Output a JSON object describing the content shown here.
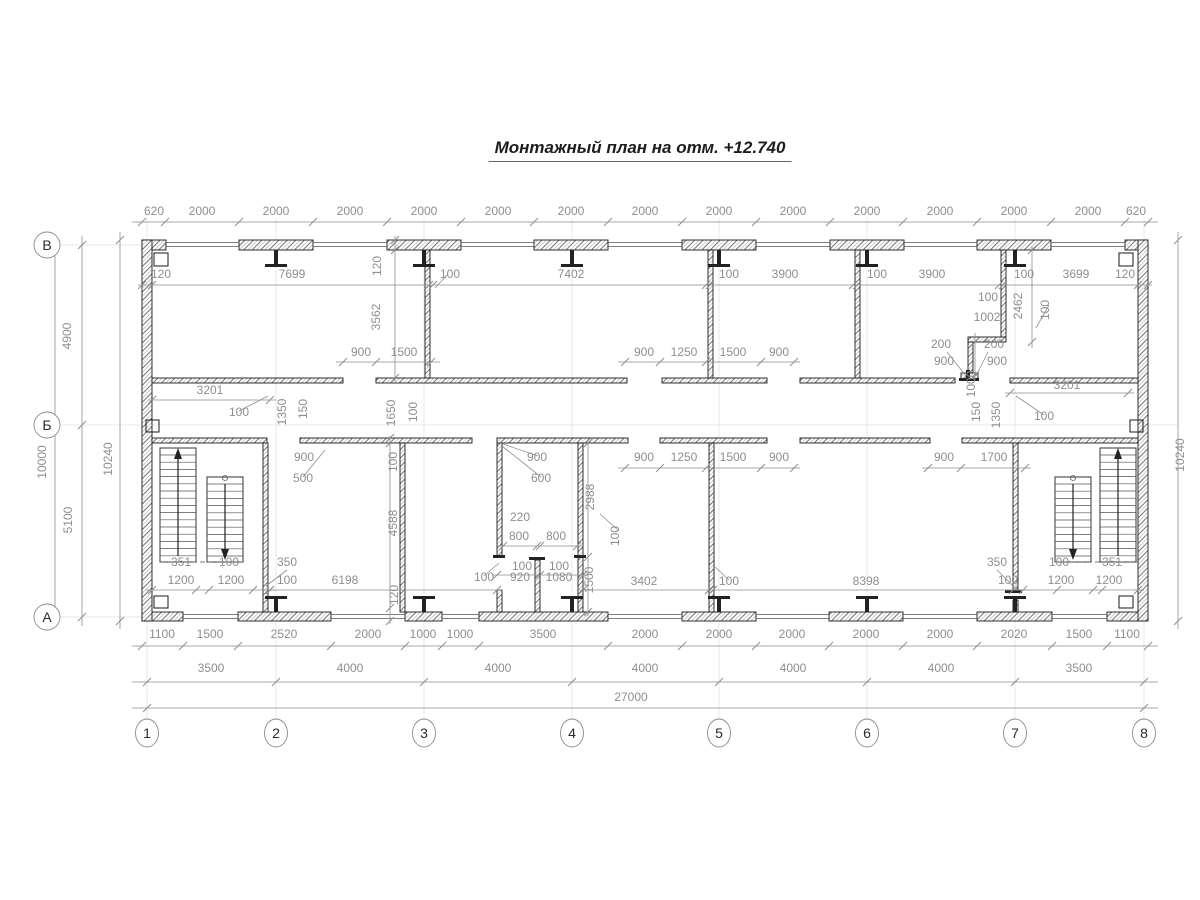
{
  "title": {
    "text": "Монтажный план на отм. +12.740"
  },
  "drawing": {
    "axis_bubbles_left": [
      {
        "label": "В",
        "x": 47,
        "y": 245
      },
      {
        "label": "Б",
        "x": 47,
        "y": 425
      },
      {
        "label": "А",
        "x": 47,
        "y": 617
      }
    ],
    "axis_bubbles_bottom": [
      {
        "label": "1",
        "x": 147,
        "y": 733
      },
      {
        "label": "2",
        "x": 276,
        "y": 733
      },
      {
        "label": "3",
        "x": 424,
        "y": 733
      },
      {
        "label": "4",
        "x": 572,
        "y": 733
      },
      {
        "label": "5",
        "x": 719,
        "y": 733
      },
      {
        "label": "6",
        "x": 867,
        "y": 733
      },
      {
        "label": "7",
        "x": 1015,
        "y": 733
      },
      {
        "label": "8",
        "x": 1144,
        "y": 733
      }
    ],
    "dim_labels": [
      {
        "t": "620",
        "x": 154,
        "y": 215
      },
      {
        "t": "2000",
        "x": 202,
        "y": 215
      },
      {
        "t": "2000",
        "x": 276,
        "y": 215
      },
      {
        "t": "2000",
        "x": 350,
        "y": 215
      },
      {
        "t": "2000",
        "x": 424,
        "y": 215
      },
      {
        "t": "2000",
        "x": 498,
        "y": 215
      },
      {
        "t": "2000",
        "x": 571,
        "y": 215
      },
      {
        "t": "2000",
        "x": 645,
        "y": 215
      },
      {
        "t": "2000",
        "x": 719,
        "y": 215
      },
      {
        "t": "2000",
        "x": 793,
        "y": 215
      },
      {
        "t": "2000",
        "x": 867,
        "y": 215
      },
      {
        "t": "2000",
        "x": 940,
        "y": 215
      },
      {
        "t": "2000",
        "x": 1014,
        "y": 215
      },
      {
        "t": "2000",
        "x": 1088,
        "y": 215
      },
      {
        "t": "620",
        "x": 1136,
        "y": 215
      },
      {
        "t": "120",
        "x": 161,
        "y": 278
      },
      {
        "t": "7699",
        "x": 292,
        "y": 278
      },
      {
        "t": "100",
        "x": 450,
        "y": 278
      },
      {
        "t": "7402",
        "x": 571,
        "y": 278
      },
      {
        "t": "100",
        "x": 729,
        "y": 278
      },
      {
        "t": "3900",
        "x": 785,
        "y": 278
      },
      {
        "t": "100",
        "x": 877,
        "y": 278
      },
      {
        "t": "3900",
        "x": 932,
        "y": 278
      },
      {
        "t": "100",
        "x": 1024,
        "y": 278
      },
      {
        "t": "3699",
        "x": 1076,
        "y": 278
      },
      {
        "t": "120",
        "x": 1125,
        "y": 278
      },
      {
        "t": "4900",
        "x": 71,
        "y": 336,
        "r": -90
      },
      {
        "t": "10000",
        "x": 46,
        "y": 462,
        "r": -90
      },
      {
        "t": "5100",
        "x": 72,
        "y": 520,
        "r": -90
      },
      {
        "t": "10240",
        "x": 112,
        "y": 459,
        "r": -90
      },
      {
        "t": "10240",
        "x": 1184,
        "y": 455,
        "r": -90
      },
      {
        "t": "120",
        "x": 381,
        "y": 266,
        "r": -90
      },
      {
        "t": "3562",
        "x": 380,
        "y": 317,
        "r": -90
      },
      {
        "t": "900",
        "x": 361,
        "y": 356
      },
      {
        "t": "1500",
        "x": 404,
        "y": 356
      },
      {
        "t": "3201",
        "x": 210,
        "y": 394
      },
      {
        "t": "100",
        "x": 239,
        "y": 416
      },
      {
        "t": "1350",
        "x": 286,
        "y": 412,
        "r": -90
      },
      {
        "t": "150",
        "x": 307,
        "y": 409,
        "r": -90
      },
      {
        "t": "1650",
        "x": 395,
        "y": 413,
        "r": -90
      },
      {
        "t": "100",
        "x": 417,
        "y": 412,
        "r": -90
      },
      {
        "t": "900",
        "x": 644,
        "y": 356
      },
      {
        "t": "1250",
        "x": 684,
        "y": 356
      },
      {
        "t": "1500",
        "x": 733,
        "y": 356
      },
      {
        "t": "900",
        "x": 779,
        "y": 356
      },
      {
        "t": "100",
        "x": 988,
        "y": 301
      },
      {
        "t": "1002",
        "x": 987,
        "y": 321
      },
      {
        "t": "2462",
        "x": 1022,
        "y": 306,
        "r": -90
      },
      {
        "t": "100",
        "x": 1049,
        "y": 310,
        "r": -90
      },
      {
        "t": "200",
        "x": 941,
        "y": 348
      },
      {
        "t": "900",
        "x": 944,
        "y": 365
      },
      {
        "t": "200",
        "x": 994,
        "y": 348
      },
      {
        "t": "900",
        "x": 997,
        "y": 365
      },
      {
        "t": "1000",
        "x": 975,
        "y": 384,
        "r": -90
      },
      {
        "t": "3201",
        "x": 1067,
        "y": 389
      },
      {
        "t": "100",
        "x": 1044,
        "y": 420
      },
      {
        "t": "150",
        "x": 980,
        "y": 412,
        "r": -90
      },
      {
        "t": "1350",
        "x": 1000,
        "y": 415,
        "r": -90
      },
      {
        "t": "900",
        "x": 304,
        "y": 461
      },
      {
        "t": "500",
        "x": 303,
        "y": 482
      },
      {
        "t": "900",
        "x": 644,
        "y": 461
      },
      {
        "t": "1250",
        "x": 684,
        "y": 461
      },
      {
        "t": "1500",
        "x": 733,
        "y": 461
      },
      {
        "t": "900",
        "x": 779,
        "y": 461
      },
      {
        "t": "900",
        "x": 944,
        "y": 461
      },
      {
        "t": "1700",
        "x": 994,
        "y": 461
      },
      {
        "t": "900",
        "x": 537,
        "y": 461
      },
      {
        "t": "600",
        "x": 541,
        "y": 482
      },
      {
        "t": "2988",
        "x": 594,
        "y": 497,
        "r": -90
      },
      {
        "t": "220",
        "x": 520,
        "y": 521
      },
      {
        "t": "800",
        "x": 519,
        "y": 540
      },
      {
        "t": "800",
        "x": 556,
        "y": 540
      },
      {
        "t": "100",
        "x": 522,
        "y": 570
      },
      {
        "t": "100",
        "x": 559,
        "y": 570
      },
      {
        "t": "100",
        "x": 484,
        "y": 581
      },
      {
        "t": "920",
        "x": 520,
        "y": 581
      },
      {
        "t": "1080",
        "x": 559,
        "y": 581
      },
      {
        "t": "1500",
        "x": 593,
        "y": 580,
        "r": -90
      },
      {
        "t": "100",
        "x": 619,
        "y": 536,
        "r": -90
      },
      {
        "t": "100",
        "x": 397,
        "y": 462,
        "r": -90
      },
      {
        "t": "4588",
        "x": 397,
        "y": 523,
        "r": -90
      },
      {
        "t": "120",
        "x": 398,
        "y": 595,
        "r": -90
      },
      {
        "t": "6198",
        "x": 345,
        "y": 584
      },
      {
        "t": "3402",
        "x": 644,
        "y": 585
      },
      {
        "t": "100",
        "x": 729,
        "y": 585
      },
      {
        "t": "8398",
        "x": 866,
        "y": 585
      },
      {
        "t": "351",
        "x": 181,
        "y": 566
      },
      {
        "t": "100",
        "x": 229,
        "y": 566
      },
      {
        "t": "350",
        "x": 287,
        "y": 566
      },
      {
        "t": "1200",
        "x": 181,
        "y": 584
      },
      {
        "t": "1200",
        "x": 231,
        "y": 584
      },
      {
        "t": "100",
        "x": 287,
        "y": 584
      },
      {
        "t": "350",
        "x": 997,
        "y": 566
      },
      {
        "t": "100",
        "x": 1059,
        "y": 566
      },
      {
        "t": "351",
        "x": 1112,
        "y": 566
      },
      {
        "t": "100",
        "x": 1008,
        "y": 584
      },
      {
        "t": "1200",
        "x": 1061,
        "y": 584
      },
      {
        "t": "1200",
        "x": 1109,
        "y": 584
      },
      {
        "t": "1100",
        "x": 162,
        "y": 638
      },
      {
        "t": "1500",
        "x": 210,
        "y": 638
      },
      {
        "t": "2520",
        "x": 284,
        "y": 638
      },
      {
        "t": "2000",
        "x": 368,
        "y": 638
      },
      {
        "t": "1000",
        "x": 423,
        "y": 638
      },
      {
        "t": "1000",
        "x": 460,
        "y": 638
      },
      {
        "t": "3500",
        "x": 543,
        "y": 638
      },
      {
        "t": "2000",
        "x": 645,
        "y": 638
      },
      {
        "t": "2000",
        "x": 719,
        "y": 638
      },
      {
        "t": "2000",
        "x": 792,
        "y": 638
      },
      {
        "t": "2000",
        "x": 866,
        "y": 638
      },
      {
        "t": "2000",
        "x": 940,
        "y": 638
      },
      {
        "t": "2020",
        "x": 1014,
        "y": 638
      },
      {
        "t": "1500",
        "x": 1079,
        "y": 638
      },
      {
        "t": "1100",
        "x": 1127,
        "y": 638
      },
      {
        "t": "3500",
        "x": 211,
        "y": 672
      },
      {
        "t": "4000",
        "x": 350,
        "y": 672
      },
      {
        "t": "4000",
        "x": 498,
        "y": 672
      },
      {
        "t": "4000",
        "x": 645,
        "y": 672
      },
      {
        "t": "4000",
        "x": 793,
        "y": 672
      },
      {
        "t": "4000",
        "x": 941,
        "y": 672
      },
      {
        "t": "3500",
        "x": 1079,
        "y": 672
      },
      {
        "t": "27000",
        "x": 631,
        "y": 701
      }
    ]
  }
}
